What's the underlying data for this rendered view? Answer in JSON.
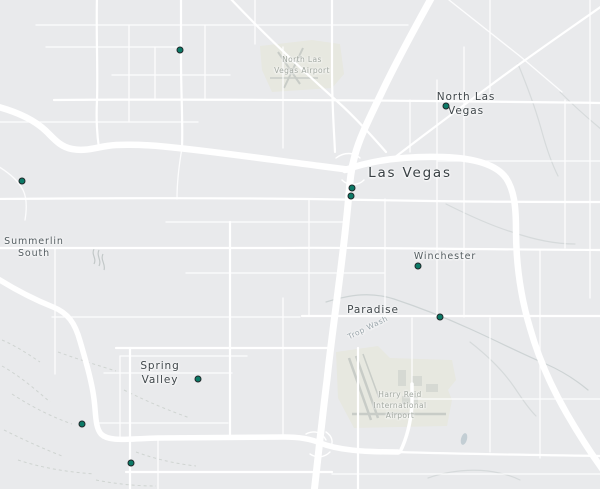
{
  "map": {
    "colors": {
      "background": "#e9eaec",
      "road": "#ffffff",
      "airport_fill": "#e7e8e0",
      "runway": "#c8ccc7",
      "terrain_line": "#cfd4d1",
      "water": "#c3ced4",
      "marker_fill": "#0c7a67",
      "marker_border": "#20282a"
    },
    "labels": [
      {
        "id": "north-las-vegas-airport",
        "text": "North Las\nVegas Airport",
        "type": "airport",
        "x": 302,
        "y": 55
      },
      {
        "id": "north-las-vegas",
        "text": "North Las\nVegas",
        "type": "city",
        "x": 466,
        "y": 91
      },
      {
        "id": "las-vegas",
        "text": "Las Vegas",
        "type": "city-major",
        "x": 410,
        "y": 165
      },
      {
        "id": "summerlin-south",
        "text": "Summerlin\nSouth",
        "type": "district",
        "x": 34,
        "y": 236
      },
      {
        "id": "winchester",
        "text": "Winchester",
        "type": "district",
        "x": 445,
        "y": 251
      },
      {
        "id": "paradise",
        "text": "Paradise",
        "type": "city",
        "x": 373,
        "y": 304
      },
      {
        "id": "trop-wash",
        "text": "Trop Wash",
        "type": "wash",
        "x": 368,
        "y": 323,
        "rotate": -26
      },
      {
        "id": "spring-valley",
        "text": "Spring\nValley",
        "type": "city",
        "x": 160,
        "y": 360
      },
      {
        "id": "harry-reid-airport",
        "text": "Harry Reid\nInternational\nAirport",
        "type": "airport",
        "x": 400,
        "y": 390
      }
    ],
    "markers": [
      {
        "id": "1",
        "x": 180,
        "y": 50
      },
      {
        "id": "2",
        "x": 22,
        "y": 181
      },
      {
        "id": "3",
        "x": 446,
        "y": 106
      },
      {
        "id": "4",
        "x": 352,
        "y": 188
      },
      {
        "id": "5",
        "x": 351,
        "y": 196
      },
      {
        "id": "6",
        "x": 418,
        "y": 266
      },
      {
        "id": "7",
        "x": 440,
        "y": 317
      },
      {
        "id": "8",
        "x": 198,
        "y": 379
      },
      {
        "id": "9",
        "x": 82,
        "y": 424
      },
      {
        "id": "10",
        "x": 131,
        "y": 463
      }
    ]
  }
}
